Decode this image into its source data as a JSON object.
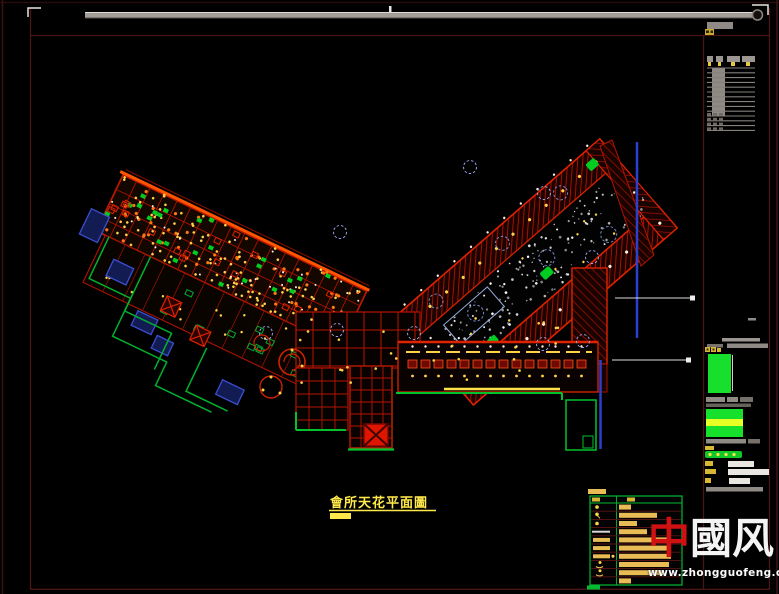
{
  "title": {
    "text": "會所天花平面圖"
  },
  "watermark": {
    "red_char": "中",
    "white_char_1": "國",
    "white_char_2": "风",
    "url": "www.zhongguofeng.com",
    "red": "#d01111",
    "white": "#f4f4f4"
  },
  "colors": {
    "frame_maroon": "#4a1615",
    "outer_maroon": "#3a1111",
    "bar_gray": "#a39d97",
    "table_gray": "#8f8a84",
    "red_line": "#b81400",
    "red_bright": "#ff5500",
    "green": "#17d22c",
    "green_line": "#00b22e",
    "yellow": "#ffd24a",
    "yellow_bright": "#ffe94a",
    "orange": "#ff7711",
    "blue": "#2b3fd0",
    "navy_fill": "#131c52",
    "star_white": "#ffffff",
    "bubble_blue": "#96a0e8",
    "legend_green": "#00bb33",
    "legend_bar": "#e9bb55",
    "sep_maroon": "#5c1414"
  },
  "drawing": {
    "seed": 7,
    "left_wing": {
      "grid_step_x": 15,
      "grid_step_y": 16,
      "dots_yellow": 120,
      "dots_orange": 55,
      "dots_white": 35,
      "green_rects": 26,
      "red_rects": 20,
      "lower_green_rects": 12,
      "lower_yellow_dots": 16
    },
    "right_wing": {
      "stars": 175,
      "core_yellow_dots": 12,
      "band_dot_step": 22
    },
    "bottom_bar": {
      "corridor_cells": 14,
      "scatter_yellow": 26
    },
    "title_block_table": {
      "rows": 14,
      "dash_rows": 4,
      "row_step": 4.8
    }
  },
  "legend": {
    "rows": [
      {
        "symbol": "dot",
        "bar_w": 12
      },
      {
        "symbol": "dot-tail",
        "bar_w": 38
      },
      {
        "symbol": "dot",
        "bar_w": 18
      },
      {
        "symbol": "dash-white",
        "bar_w": 28
      },
      {
        "symbol": "bar",
        "bar_w": 48
      },
      {
        "symbol": "bar",
        "bar_w": 50
      },
      {
        "symbol": "bar-dot",
        "bar_w": 52
      },
      {
        "symbol": "squiggle",
        "bar_w": 50
      },
      {
        "symbol": "squiggle",
        "bar_w": 45
      },
      {
        "symbol": "none",
        "bar_w": 12
      }
    ]
  }
}
